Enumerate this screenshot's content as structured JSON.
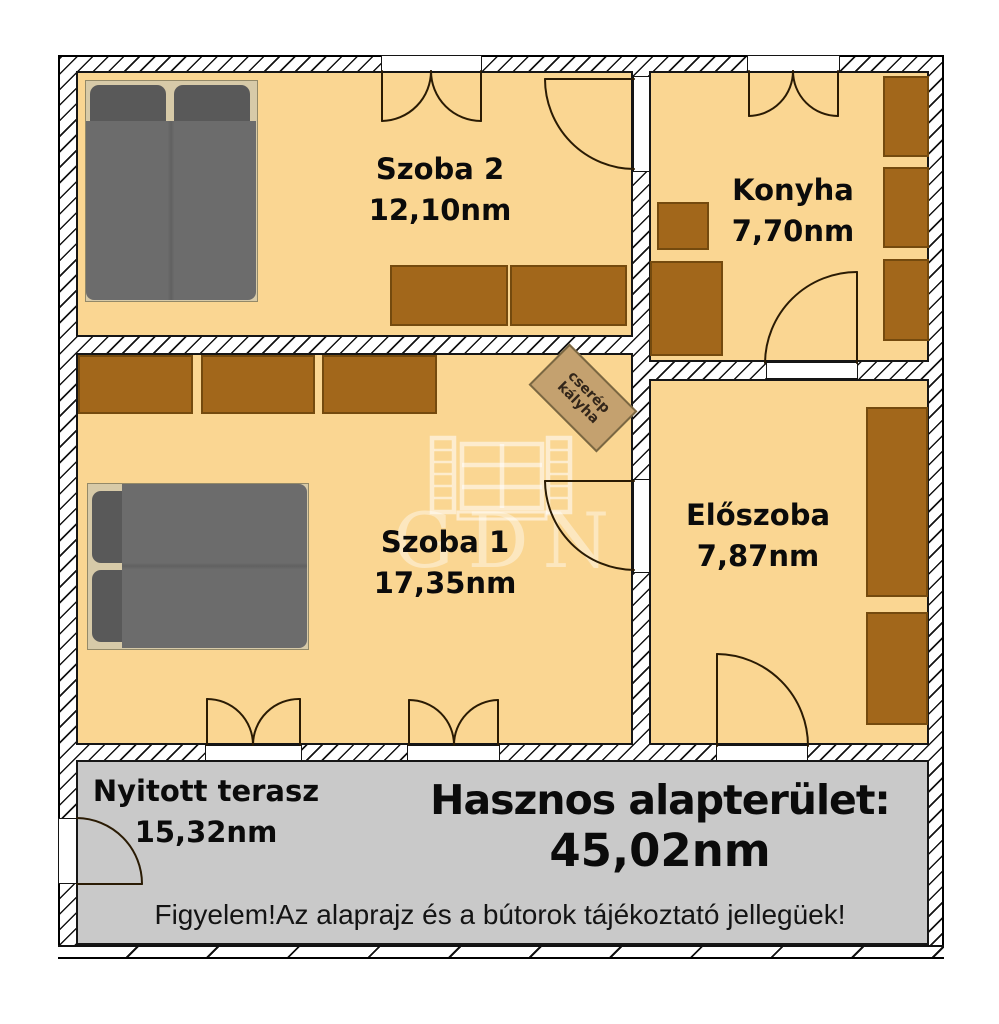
{
  "plan": {
    "rooms": [
      {
        "name": "Szoba 2",
        "area": "12,10nm"
      },
      {
        "name": "Konyha",
        "area": "7,70nm"
      },
      {
        "name": "Szoba 1",
        "area": "17,35nm"
      },
      {
        "name": "Előszoba",
        "area": "7,87nm"
      },
      {
        "name": "Nyitott terasz",
        "area": "15,32nm"
      }
    ],
    "stove": {
      "line1": "cserép",
      "line2": "kályha"
    },
    "summary": {
      "label": "Hasznos alapterület:",
      "value": "45,02nm"
    },
    "disclaimer": "Figyelem!Az alaprajz és a bútorok tájékoztató jellegüek!",
    "watermark": "GDN",
    "colors": {
      "floor": "#FAD692",
      "wall": "#FFFFFF",
      "furniture": "#A2671B",
      "bed": "#6C6C6C",
      "terrace": "#C9C9C9",
      "stove": "#C4A16F"
    }
  }
}
